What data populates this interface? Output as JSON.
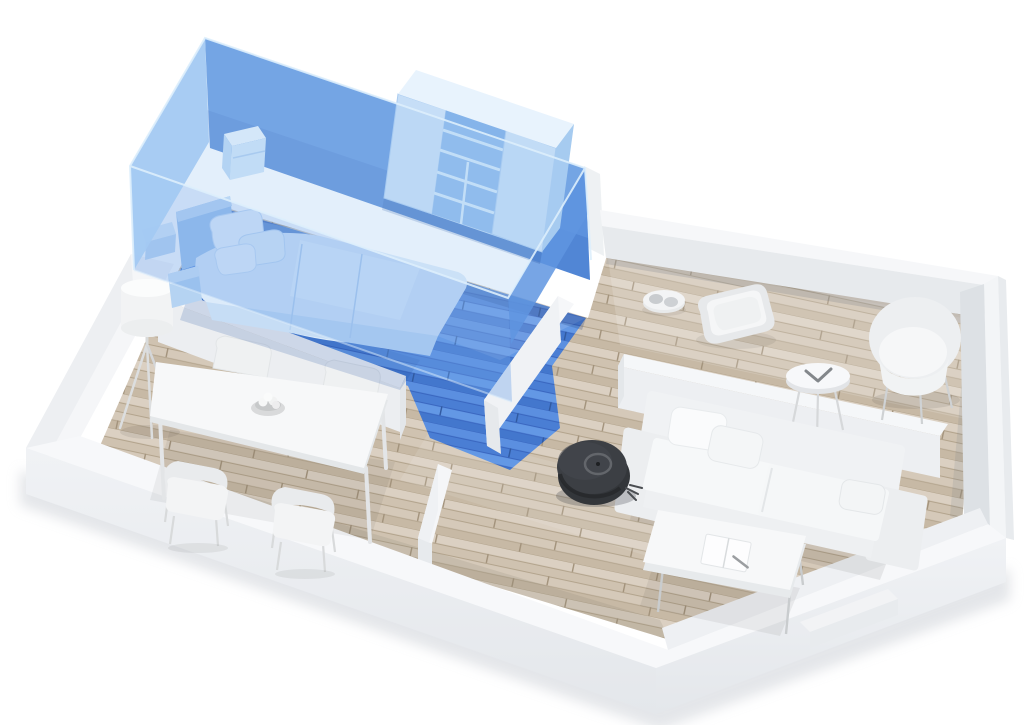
{
  "scene": {
    "type": "3d-floor-plan-render",
    "description": "Isometric 3D render of an apartment floor plan; bedroom zone highlighted with a translucent blue box; robot vacuum on the hallway floor",
    "highlighted_room": "bedroom",
    "rooms": [
      {
        "id": "bedroom",
        "label": "Bedroom",
        "highlighted": true,
        "furniture": [
          "double bed with pillows and duvet",
          "headboard",
          "bedside cube shelf",
          "wall shelf",
          "wardrobe with open shelving"
        ]
      },
      {
        "id": "dining-area",
        "label": "Dining area",
        "highlighted": false,
        "furniture": [
          "rectangular dining table",
          "four shell chairs",
          "fruit bowl",
          "tripod floor lamp"
        ]
      },
      {
        "id": "living-room",
        "label": "Living room",
        "highlighted": false,
        "furniture": [
          "two-seat sofa",
          "two sofa cushions",
          "armrest cushion",
          "coffee table",
          "open magazine",
          "round side table",
          "tub armchair",
          "pet bed",
          "double pet bowl"
        ]
      },
      {
        "id": "hallway",
        "label": "Hallway",
        "highlighted": false,
        "furniture": []
      }
    ],
    "robot_vacuum": {
      "label": "Robot vacuum",
      "location": "hallway floor near sofa",
      "shape": "round disc with top ring sensor and side brush"
    }
  },
  "colors": {
    "background": "#ffffff",
    "wall_top": "#f7f8fa",
    "wall_outer": "#ebedf0",
    "wall_inner": "#e3e6ea",
    "floor_plank_light": "#dbd0c2",
    "floor_plank_mid": "#cfc2b0",
    "floor_plank_dark": "#c7b9a5",
    "floor_seam": "#b3a48d",
    "highlight_back_wall": "#5c92de",
    "highlight_left_face": "#a3c9f2",
    "highlight_veil": "#6ea3e8",
    "highlight_top": "#a9cdf3",
    "highlight_floor": "#4a7ed4",
    "wardrobe_front": "#bcd9f4",
    "bed_duvet": "#dcebfa",
    "sofa_white": "#f0f2f4",
    "furniture_white": "#f7f8f9",
    "robot_body": "#33363a",
    "robot_top": "#3c3f44",
    "robot_ring": "#63666b",
    "shadow": "rgba(70,80,100,0.18)"
  }
}
